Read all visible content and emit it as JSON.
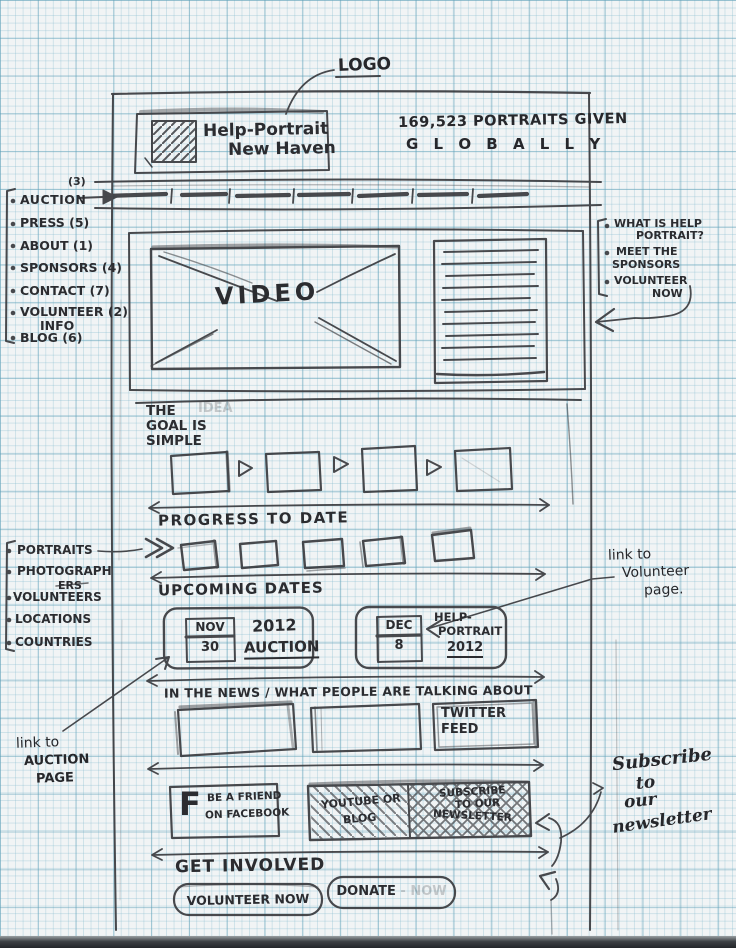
{
  "header": {
    "logo": {
      "line1": "Help-Portrait",
      "line2": "New Haven"
    },
    "stat": {
      "line1": "169,523 PORTRAITS GIVEN",
      "line2": "G L O B A L L Y"
    }
  },
  "nav": {
    "placeholder_slots": 7
  },
  "left_nav_notes": {
    "items": [
      {
        "label": "AUCTION",
        "number": "(3)"
      },
      {
        "label": "PRESS",
        "number": "(5)"
      },
      {
        "label": "ABOUT",
        "number": "(1)"
      },
      {
        "label": "SPONSORS",
        "number": "(4)"
      },
      {
        "label": "CONTACT",
        "number": "(7)"
      },
      {
        "label": "VOLUNTEER",
        "label2": "INFO",
        "number": "(2)"
      },
      {
        "label": "BLOG",
        "number": "(6)"
      }
    ]
  },
  "sidebar_notes": {
    "items": [
      {
        "line1": "WHAT IS HELP",
        "line2": "PORTRAIT?"
      },
      {
        "line1": "MEET THE",
        "line2": "SPONSORS"
      },
      {
        "line1": "VOLUNTEER",
        "line2": "NOW"
      }
    ]
  },
  "video_section": {
    "label": "VIDEO"
  },
  "goal_section": {
    "line1": "THE",
    "line2": "GOAL IS",
    "line3": "SIMPLE",
    "ghost": "IDEA"
  },
  "progress_section": {
    "heading": "PROGRESS TO DATE"
  },
  "stats_notes": {
    "items": [
      {
        "line1": "PORTRAITS"
      },
      {
        "line1": "PHOTOGRAPH",
        "line2": "ERS"
      },
      {
        "line1": "VOLUNTEERS"
      },
      {
        "line1": "LOCATIONS"
      },
      {
        "line1": "COUNTRIES"
      }
    ]
  },
  "upcoming_section": {
    "heading": "UPCOMING DATES",
    "event1": {
      "month": "NOV",
      "day": "30",
      "title_line1": "2012",
      "title_line2": "AUCTION"
    },
    "event2": {
      "month": "DEC",
      "day": "8",
      "title_line1": "HELP-",
      "title_line2": "PORTRAIT",
      "title_line3": "2012"
    }
  },
  "news_section": {
    "heading": "IN THE NEWS / WHAT PEOPLE ARE TALKING ABOUT",
    "twitter": {
      "line1": "TWITTER",
      "line2": "FEED"
    }
  },
  "social_section": {
    "facebook_icon": "F",
    "facebook": {
      "line1": "BE A FRIEND",
      "line2": "ON FACEBOOK"
    },
    "youtube_blog": {
      "line1": "YOUTUBE OR",
      "line2": "BLOG"
    },
    "newsletter": {
      "line1": "SUBSCRIBE",
      "line2": "TO OUR",
      "line3": "NEWSLETTER"
    }
  },
  "get_involved": {
    "heading": "GET INVOLVED",
    "volunteer_button": "VOLUNTEER NOW",
    "donate_button": "DONATE",
    "donate_ghost": "- NOW"
  },
  "annotations": {
    "logo_label": "LOGO",
    "auction_link": {
      "line1": "link to",
      "line2": "AUCTION",
      "line3": "PAGE"
    },
    "volunteer_link": {
      "line1": "link to",
      "line2": "Volunteer",
      "line3": "page."
    },
    "newsletter_note": {
      "line1": "Subscribe",
      "line2": "to",
      "line3": "our",
      "line4": "newsletter"
    }
  }
}
